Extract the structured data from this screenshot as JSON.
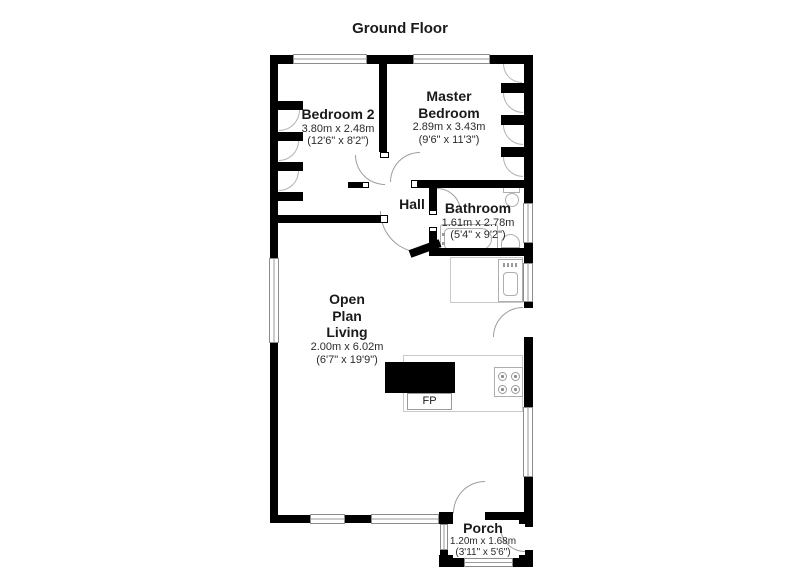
{
  "title": "Ground Floor",
  "rooms": {
    "bedroom2": {
      "name": "Bedroom 2",
      "metric": "3.80m x 2.48m",
      "imperial": "(12'6\" x 8'2\")"
    },
    "master_bedroom": {
      "line1": "Master",
      "line2": "Bedroom",
      "metric": "2.89m x 3.43m",
      "imperial": "(9'6\" x 11'3\")"
    },
    "hall": {
      "name": "Hall"
    },
    "bathroom": {
      "name": "Bathroom",
      "metric": "1.61m x 2.78m",
      "imperial": "(5'4\" x 9'2\")"
    },
    "open_plan_living": {
      "line1": "Open",
      "line2": "Plan",
      "line3": "Living",
      "metric": "2.00m x 6.02m",
      "imperial": "(6'7\" x 19'9\")"
    },
    "porch": {
      "name": "Porch",
      "metric": "1.20m x 1.68m",
      "imperial": "(3'11\" x 5'6\")"
    }
  },
  "fireplace_label": "FP",
  "colors": {
    "wall": "#000000",
    "window_line": "#9a9a9a",
    "fixture_line": "#aeaeae",
    "background": "#ffffff",
    "text": "#1a1a1a"
  }
}
